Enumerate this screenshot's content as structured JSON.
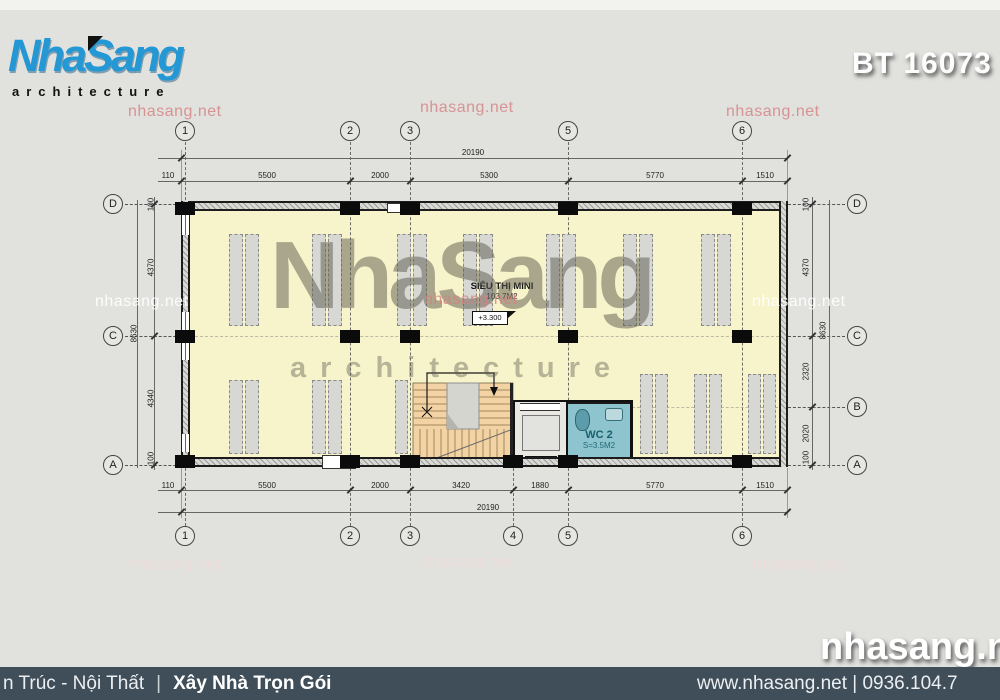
{
  "header": {
    "logo_title": "NhaSang",
    "logo_subtitle": "architecture",
    "project_code": "BT 16073"
  },
  "watermark": {
    "site": "nhasang.net",
    "center_title": "NhaSang",
    "center_subtitle": "architecture",
    "corner": "nhasang.net"
  },
  "plan": {
    "room_label": "SIÊU THỊ MINI",
    "room_area": "103.7M2",
    "room_elevation": "+3.300",
    "wc_label": "WC 2",
    "wc_area": "S=3.5M2",
    "grid_cols_top": [
      "1",
      "2",
      "3",
      "5",
      "6"
    ],
    "grid_cols_bottom": [
      "1",
      "2",
      "3",
      "4",
      "5",
      "6"
    ],
    "grid_rows_left": [
      "D",
      "C",
      "A"
    ],
    "grid_rows_right": [
      "D",
      "C",
      "B",
      "A"
    ],
    "dims_top_overall": "20190",
    "dims_top": [
      "110",
      "5500",
      "2000",
      "5300",
      "5770",
      "1510"
    ],
    "dims_bottom": [
      "110",
      "5500",
      "2000",
      "3420",
      "1880",
      "5770",
      "1510"
    ],
    "dims_bottom_overall": "20190",
    "dims_left": [
      "100",
      "4370",
      "4340",
      "100"
    ],
    "dims_left_overall": "8630",
    "dims_right": [
      "100",
      "4370",
      "2320",
      "2020",
      "100"
    ],
    "dims_right_overall": "8630"
  },
  "footer": {
    "left_text": "n Trúc - Nội Thất",
    "divider": "|",
    "left_bold": "Xây Nhà Trọn Gói",
    "right_text": "www.nhasang.net | 0936.104.7"
  },
  "colors": {
    "brand_blue": "#2398d4",
    "footer_bg": "#3f4e59",
    "floor": "#f7f3cb",
    "stairs": "#f3d2a4",
    "wc": "#8ec4cd",
    "watermark_pink": "#d58080"
  }
}
